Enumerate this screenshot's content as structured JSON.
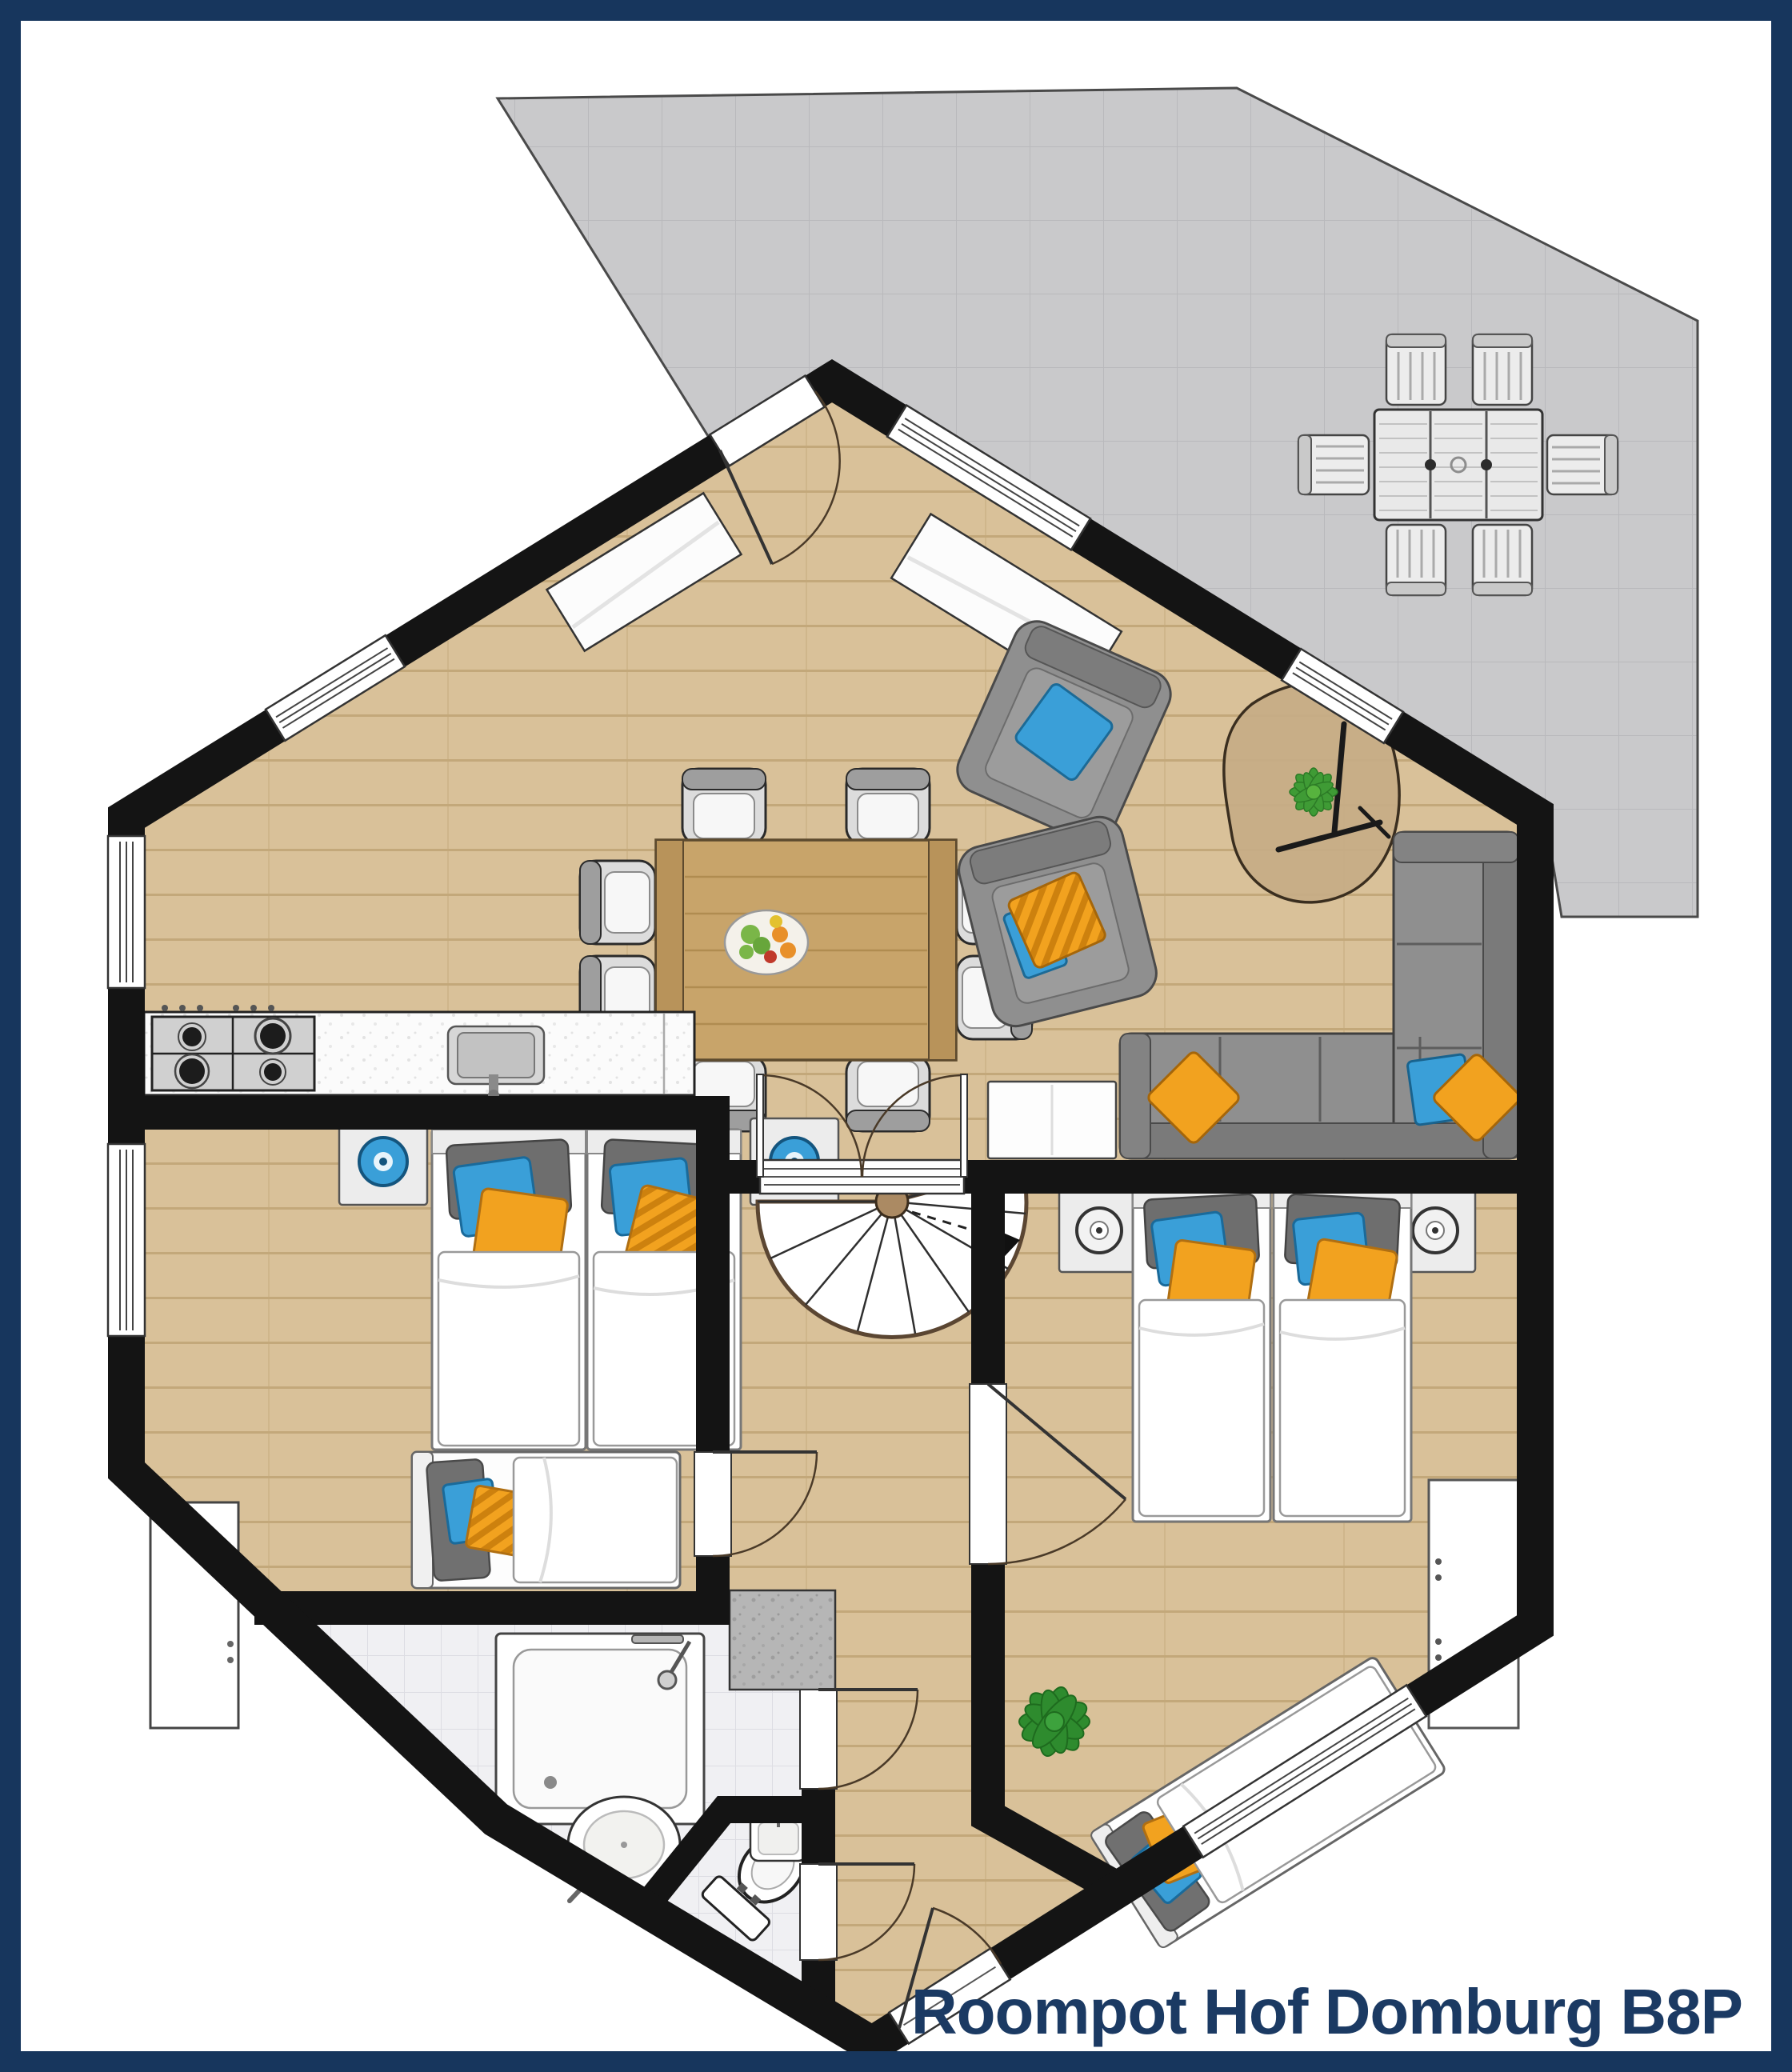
{
  "title": "Roompot Hof Domburg B8P",
  "colors": {
    "frame_navy": "#17365d",
    "title_navy": "#1b3a63",
    "wall_black": "#141414",
    "wood_floor": "#d9c199",
    "wood_line": "#c3a87a",
    "terrace_gray": "#c9c9cb",
    "tile_gray": "#f0f0f3",
    "pillow_orange": "#f2a21f",
    "pillow_blue": "#3a9fd8",
    "sofa_gray": "#8f8f8f",
    "plant_green": "#3f9b35",
    "table_wood": "#c8a46a"
  },
  "floor_plan": {
    "rooms": [
      "terrace",
      "living-dining-room",
      "kitchen",
      "hallway",
      "bedroom-left",
      "bedroom-right",
      "bathroom",
      "toilet"
    ],
    "furniture": {
      "terrace": [
        "outdoor-table",
        "outdoor-chair x6"
      ],
      "living_dining": [
        "dining-table",
        "dining-chair x8",
        "fruit-bowl",
        "armchair x2",
        "coffee-table",
        "plant",
        "corner-sofa",
        "sideboard x2",
        "tv-sideboard"
      ],
      "kitchen": [
        "counter",
        "stove",
        "sink"
      ],
      "hallway": [
        "spiral-staircase",
        "storage-closet"
      ],
      "bedroom_left": [
        "single-bed x2",
        "nightstand x2",
        "single-bed",
        "wardrobe"
      ],
      "bedroom_right": [
        "single-bed x2",
        "nightstand x2",
        "angled-single-bed",
        "dresser",
        "plant"
      ],
      "bathroom": [
        "shower",
        "washbasin",
        "toilet",
        "toilet-washbasin"
      ]
    }
  }
}
